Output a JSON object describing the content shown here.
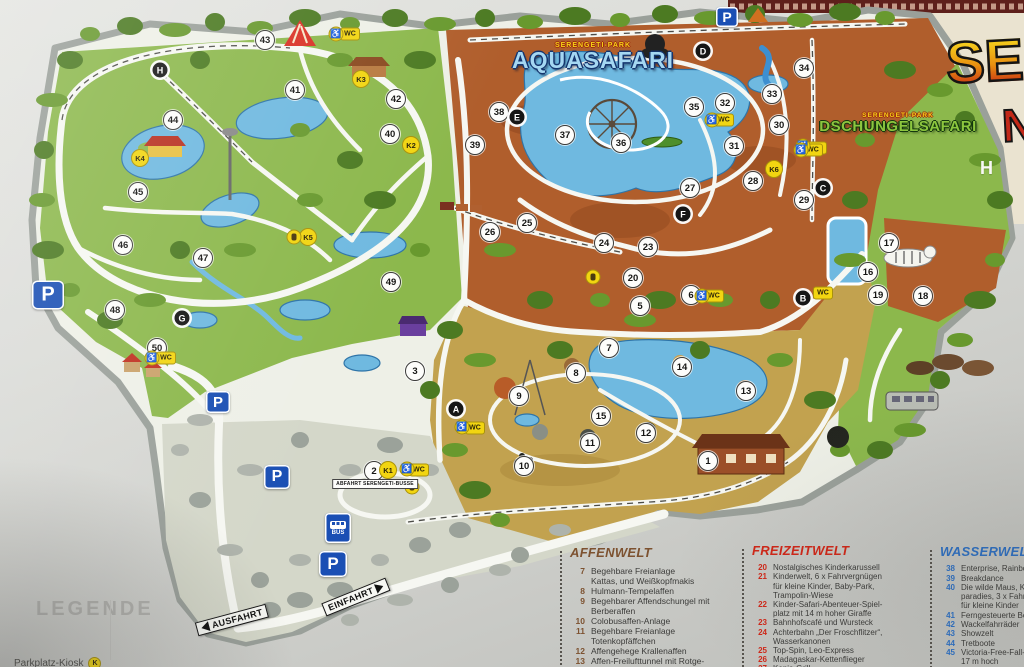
{
  "board": {
    "legende": "LEGENDE",
    "parkplatz_kiosk": "Parkplatz-Kiosk",
    "kiosk_badge": "K"
  },
  "logo": {
    "main": "SERE",
    "fragment": "N",
    "sub_letter": "H"
  },
  "region_labels": {
    "aquasafari": {
      "small": "SERENGETI-PARK",
      "big": "AQUASAFARI"
    },
    "dschungelsafari": {
      "small": "SERENGETI-PARK",
      "big": "DSCHUNGELSAFARI"
    }
  },
  "signs": {
    "parking_label": "P",
    "bus_label": "BUS",
    "bus_stop_label": "ABFAHRT SERENGETI-BUSSE",
    "direction": [
      {
        "label": "EINFAHRT",
        "x": 356,
        "y": 597,
        "rot": -22,
        "arrow": "right"
      },
      {
        "label": "AUSFAHRT",
        "x": 232,
        "y": 620,
        "rot": -15,
        "arrow": "left"
      }
    ],
    "p_positions": [
      {
        "x": 48,
        "y": 295,
        "s": 32
      },
      {
        "x": 218,
        "y": 402,
        "s": 24
      },
      {
        "x": 277,
        "y": 477,
        "s": 26
      },
      {
        "x": 727,
        "y": 17,
        "s": 22
      },
      {
        "x": 333,
        "y": 564,
        "s": 28
      }
    ],
    "bus_position": {
      "x": 338,
      "y": 528
    },
    "bus_stop_position": {
      "x": 375,
      "y": 484
    }
  },
  "markers": {
    "numbers": [
      {
        "n": "1",
        "x": 708,
        "y": 461
      },
      {
        "n": "2",
        "x": 374,
        "y": 471
      },
      {
        "n": "3",
        "x": 415,
        "y": 371
      },
      {
        "n": "5",
        "x": 640,
        "y": 306
      },
      {
        "n": "6",
        "x": 691,
        "y": 295
      },
      {
        "n": "7",
        "x": 609,
        "y": 348
      },
      {
        "n": "8",
        "x": 576,
        "y": 373
      },
      {
        "n": "9",
        "x": 519,
        "y": 396
      },
      {
        "n": "10",
        "x": 524,
        "y": 466
      },
      {
        "n": "11",
        "x": 590,
        "y": 443
      },
      {
        "n": "12",
        "x": 646,
        "y": 433
      },
      {
        "n": "13",
        "x": 746,
        "y": 391
      },
      {
        "n": "14",
        "x": 682,
        "y": 367
      },
      {
        "n": "15",
        "x": 601,
        "y": 416
      },
      {
        "n": "16",
        "x": 868,
        "y": 272
      },
      {
        "n": "17",
        "x": 889,
        "y": 243
      },
      {
        "n": "18",
        "x": 923,
        "y": 296
      },
      {
        "n": "19",
        "x": 878,
        "y": 295
      },
      {
        "n": "20",
        "x": 633,
        "y": 278
      },
      {
        "n": "23",
        "x": 648,
        "y": 247
      },
      {
        "n": "24",
        "x": 604,
        "y": 243
      },
      {
        "n": "25",
        "x": 527,
        "y": 223
      },
      {
        "n": "26",
        "x": 490,
        "y": 232
      },
      {
        "n": "27",
        "x": 690,
        "y": 188
      },
      {
        "n": "28",
        "x": 753,
        "y": 181
      },
      {
        "n": "29",
        "x": 804,
        "y": 200
      },
      {
        "n": "30",
        "x": 779,
        "y": 125
      },
      {
        "n": "31",
        "x": 734,
        "y": 146
      },
      {
        "n": "32",
        "x": 725,
        "y": 103
      },
      {
        "n": "33",
        "x": 772,
        "y": 94
      },
      {
        "n": "34",
        "x": 804,
        "y": 68
      },
      {
        "n": "35",
        "x": 694,
        "y": 107
      },
      {
        "n": "36",
        "x": 621,
        "y": 143
      },
      {
        "n": "37",
        "x": 565,
        "y": 135
      },
      {
        "n": "38",
        "x": 499,
        "y": 112
      },
      {
        "n": "39",
        "x": 475,
        "y": 145
      },
      {
        "n": "40",
        "x": 390,
        "y": 134
      },
      {
        "n": "41",
        "x": 295,
        "y": 90
      },
      {
        "n": "42",
        "x": 396,
        "y": 99
      },
      {
        "n": "43",
        "x": 265,
        "y": 40
      },
      {
        "n": "44",
        "x": 173,
        "y": 120
      },
      {
        "n": "45",
        "x": 138,
        "y": 192
      },
      {
        "n": "46",
        "x": 123,
        "y": 245
      },
      {
        "n": "47",
        "x": 203,
        "y": 258
      },
      {
        "n": "48",
        "x": 115,
        "y": 310
      },
      {
        "n": "49",
        "x": 391,
        "y": 282
      },
      {
        "n": "50",
        "x": 157,
        "y": 348
      }
    ],
    "letters": [
      {
        "n": "A",
        "x": 456,
        "y": 409
      },
      {
        "n": "B",
        "x": 803,
        "y": 298
      },
      {
        "n": "C",
        "x": 823,
        "y": 188
      },
      {
        "n": "D",
        "x": 703,
        "y": 51
      },
      {
        "n": "E",
        "x": 517,
        "y": 117
      },
      {
        "n": "F",
        "x": 683,
        "y": 214
      },
      {
        "n": "G",
        "x": 182,
        "y": 318
      },
      {
        "n": "H",
        "x": 160,
        "y": 70
      }
    ],
    "kiosks": [
      {
        "n": "K1",
        "x": 388,
        "y": 470
      },
      {
        "n": "K2",
        "x": 411,
        "y": 145
      },
      {
        "n": "K3",
        "x": 361,
        "y": 79
      },
      {
        "n": "K4",
        "x": 140,
        "y": 158
      },
      {
        "n": "K5",
        "x": 308,
        "y": 237
      },
      {
        "n": "K6",
        "x": 774,
        "y": 169
      }
    ],
    "wc": {
      "label": "WC",
      "positions": [
        {
          "x": 350,
          "y": 34
        },
        {
          "x": 817,
          "y": 148
        },
        {
          "x": 724,
          "y": 120
        },
        {
          "x": 813,
          "y": 150
        },
        {
          "x": 823,
          "y": 293
        },
        {
          "x": 714,
          "y": 296
        },
        {
          "x": 475,
          "y": 428
        },
        {
          "x": 166,
          "y": 358
        },
        {
          "x": 419,
          "y": 470
        }
      ]
    },
    "wheelchair": {
      "glyph": "♿",
      "positions": [
        {
          "x": 336,
          "y": 34
        },
        {
          "x": 803,
          "y": 146
        },
        {
          "x": 712,
          "y": 120
        },
        {
          "x": 801,
          "y": 150
        },
        {
          "x": 702,
          "y": 296
        },
        {
          "x": 462,
          "y": 427
        },
        {
          "x": 152,
          "y": 358
        },
        {
          "x": 407,
          "y": 469
        }
      ]
    },
    "misc_badges": [
      {
        "x": 294,
        "y": 237
      },
      {
        "x": 593,
        "y": 277
      },
      {
        "x": 412,
        "y": 487
      }
    ]
  },
  "legend": {
    "sections": [
      {
        "title": "AFFENWELT",
        "color": "#7d5230",
        "x": 570,
        "y": 548,
        "cls": "leg-a",
        "items": [
          {
            "n": "7",
            "lines": [
              "Begehbare Freianlage",
              "Kattas, und Weißkopfmakis"
            ]
          },
          {
            "n": "8",
            "lines": [
              "Hulmann-Tempelaffen"
            ]
          },
          {
            "n": "9",
            "lines": [
              "Begehbarer Affendschungel mit",
              "Berberaffen"
            ]
          },
          {
            "n": "10",
            "lines": [
              "Colobusaffen-Anlage"
            ]
          },
          {
            "n": "11",
            "lines": [
              "Begehbare Freianlage",
              "Totenkopfäffchen"
            ]
          },
          {
            "n": "12",
            "lines": [
              "Affengehege Krallenaffen"
            ]
          },
          {
            "n": "13",
            "lines": [
              "Affen-Freilufttunnel mit Rotge-",
              "sichtsmakaken, Haubenkapuz-"
            ]
          }
        ]
      },
      {
        "title": "FREIZEITWELT",
        "color": "#d02718",
        "x": 752,
        "y": 546,
        "cls": "leg-f",
        "items": [
          {
            "n": "20",
            "lines": [
              "Nostalgisches Kinderkarussell"
            ]
          },
          {
            "n": "21",
            "lines": [
              "Kinderwelt, 6 x Fahrvergnügen",
              "für kleine Kinder, Baby-Park,",
              "Trampolin-Wiese"
            ]
          },
          {
            "n": "22",
            "lines": [
              "Kinder-Safari-Abenteuer-Spiel-",
              "platz mit 14 m hoher Giraffe"
            ]
          },
          {
            "n": "23",
            "lines": [
              "Bahnhofscafé und Wursteck"
            ]
          },
          {
            "n": "24",
            "lines": [
              "Achterbahn „Der Froschflitzer“,",
              "Wasserkanonen"
            ]
          },
          {
            "n": "25",
            "lines": [
              "Top-Spin, Leo-Express"
            ]
          },
          {
            "n": "26",
            "lines": [
              "Madagaskar-Kettenflieger"
            ]
          },
          {
            "n": "27",
            "lines": [
              "Kenia-Grill"
            ]
          }
        ]
      },
      {
        "title": "WASSERWELT",
        "color": "#2d6fc2",
        "x": 940,
        "y": 547,
        "cls": "leg-w",
        "items": [
          {
            "n": "38",
            "lines": [
              "Enterprise, Rainbo"
            ]
          },
          {
            "n": "39",
            "lines": [
              "Breakdance"
            ]
          },
          {
            "n": "40",
            "lines": [
              "Die wilde Maus, Kin",
              "paradies, 3 x Fahrg",
              "für kleine Kinder"
            ]
          },
          {
            "n": "41",
            "lines": [
              "Ferngesteuerte Boo"
            ]
          },
          {
            "n": "42",
            "lines": [
              "Wackelfahrräder"
            ]
          },
          {
            "n": "43",
            "lines": [
              "Showzelt"
            ]
          },
          {
            "n": "44",
            "lines": [
              "Tretboote"
            ]
          },
          {
            "n": "45",
            "lines": [
              "Victoria-Free-Fall-Tow",
              "17 m hoch"
            ]
          }
        ]
      }
    ]
  },
  "colors": {
    "badge_yellow": "#f2d511",
    "parking_blue": "#1a4fb4",
    "water": "#6fb9e0",
    "grass": "#8cb84c",
    "savanna": "#b05e2c",
    "monkey_world": "#c2a24f"
  }
}
